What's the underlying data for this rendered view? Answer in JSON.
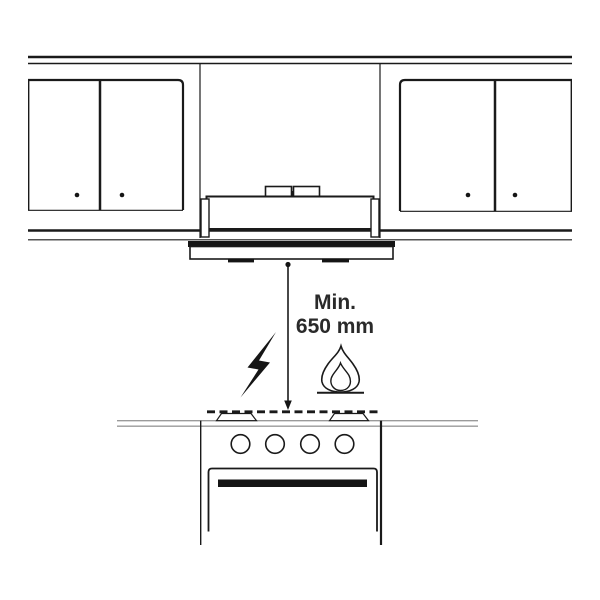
{
  "clearance": {
    "label_line1": "Min.",
    "label_line2": "650 mm"
  },
  "icons": {
    "electric_hob": "lightning-bolt-icon",
    "gas_hob": "flame-icon",
    "arrow": "distance-arrow-down"
  },
  "colors": {
    "line": "#1a1a1a",
    "hood_fill": "#e9e9e9",
    "visor_fill": "#ededed",
    "burner_fill": "#d8d8d8",
    "counter_line": "#9a9a9a",
    "text": "#2a2a2a",
    "background": "#ffffff"
  }
}
